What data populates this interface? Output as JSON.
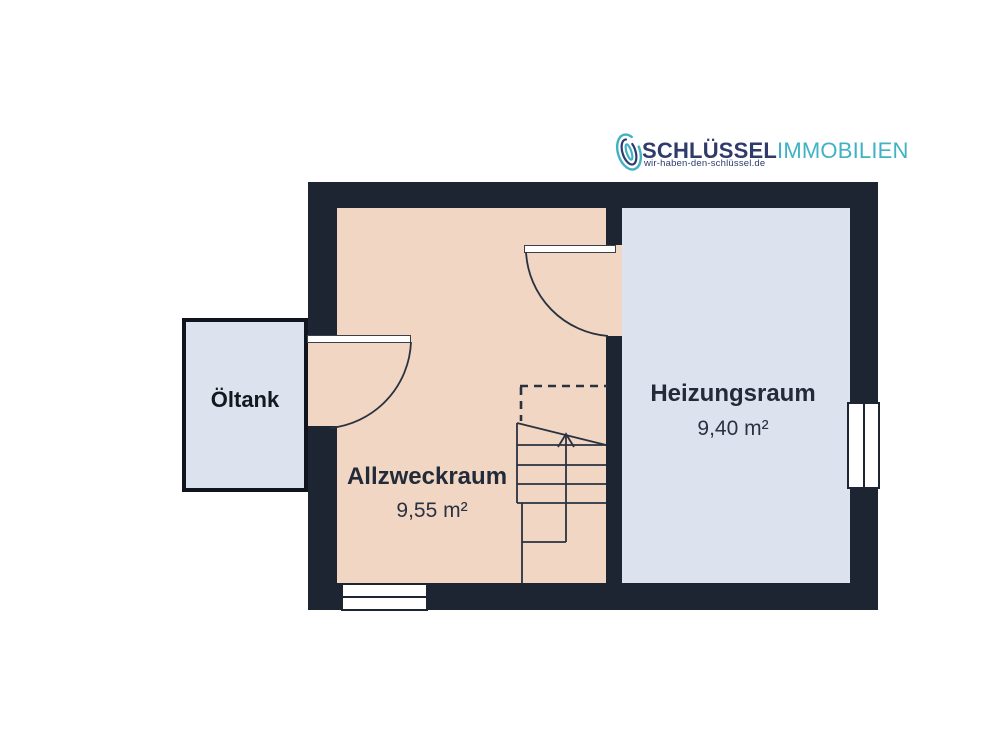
{
  "logo": {
    "brand_primary": "SCHLÜSSEL",
    "brand_secondary": "IMMOBILIEN",
    "tagline": "wir-haben-den-schlüssel.de",
    "primary_color": "#2e3b6b",
    "secondary_color": "#41b2c4",
    "icon": "fingerprint-icon"
  },
  "floorplan": {
    "wall_color": "#1d2533",
    "line_color": "#2a3240",
    "rooms": [
      {
        "name": "Öltank",
        "fill": "#dde3ee"
      },
      {
        "name": "Allzweckraum",
        "area": "9,55 m²",
        "fill": "#f0d6c3"
      },
      {
        "name": "Heizungsraum",
        "area": "9,40 m²",
        "fill": "#dde3ee"
      }
    ]
  }
}
